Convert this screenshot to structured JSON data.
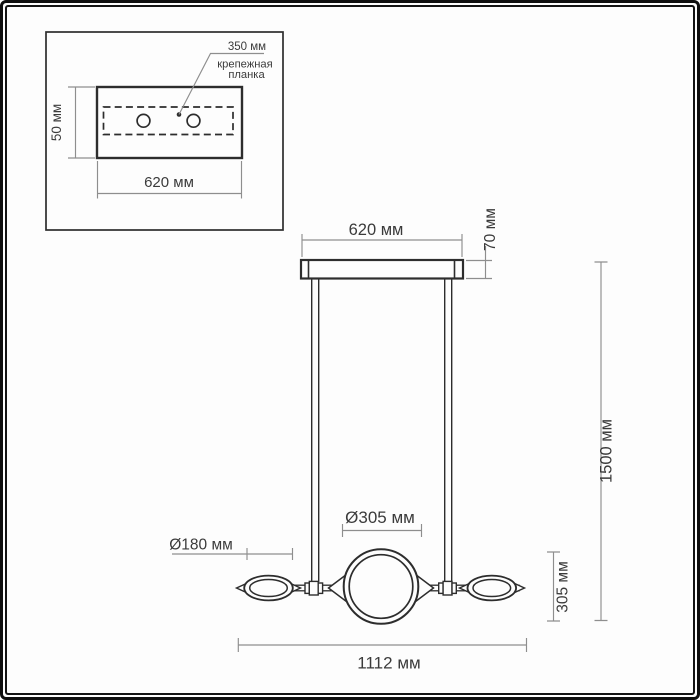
{
  "figure": {
    "kind": "pendant-light-dimension-drawing",
    "units": "mm"
  },
  "colors": {
    "background": "#fdfdfd",
    "frame": "#0f0f0f",
    "object_line": "#2d2d2d",
    "dimension_line": "#8e8e8e",
    "text": "#3b3b3b"
  },
  "inset": {
    "plate_width_label": "350 мм",
    "plate_name_line1": "крепежная",
    "plate_name_line2": "планка",
    "canopy_depth_label": "50 мм",
    "canopy_width_label": "620 мм"
  },
  "main": {
    "canopy_width_label": "620 мм",
    "canopy_height_label": "70 мм",
    "overall_height_label": "1500 мм",
    "shade_section_height_label": "305 мм",
    "center_shade_diameter_label": "Ø305 мм",
    "side_shade_diameter_label": "Ø180 мм",
    "overall_width_label": "1112 мм"
  }
}
